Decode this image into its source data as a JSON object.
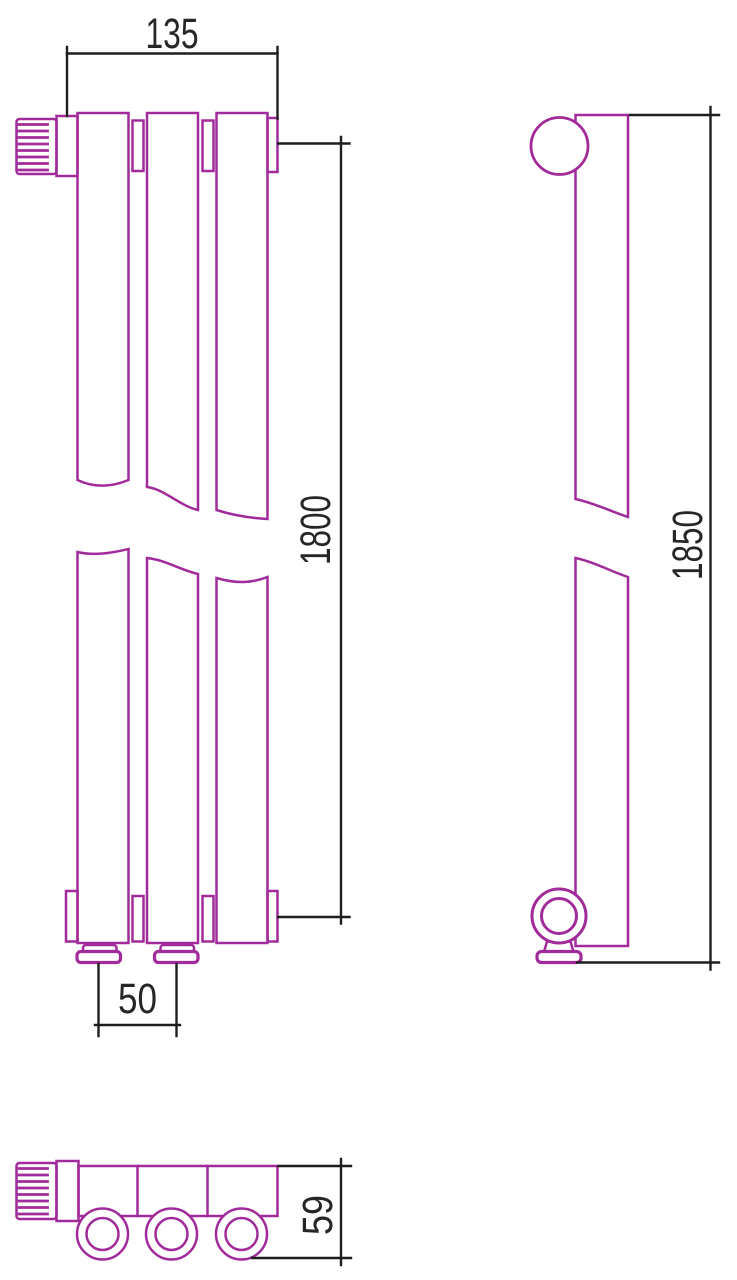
{
  "drawing": {
    "stroke_color": "#A12B9B",
    "dim_line_color": "#1E1E1E",
    "dim_text_color": "#262626",
    "dimensions": {
      "width": "135",
      "column_height": "1800",
      "connection_pitch": "50",
      "overall_height": "1850",
      "depth": "59"
    }
  }
}
